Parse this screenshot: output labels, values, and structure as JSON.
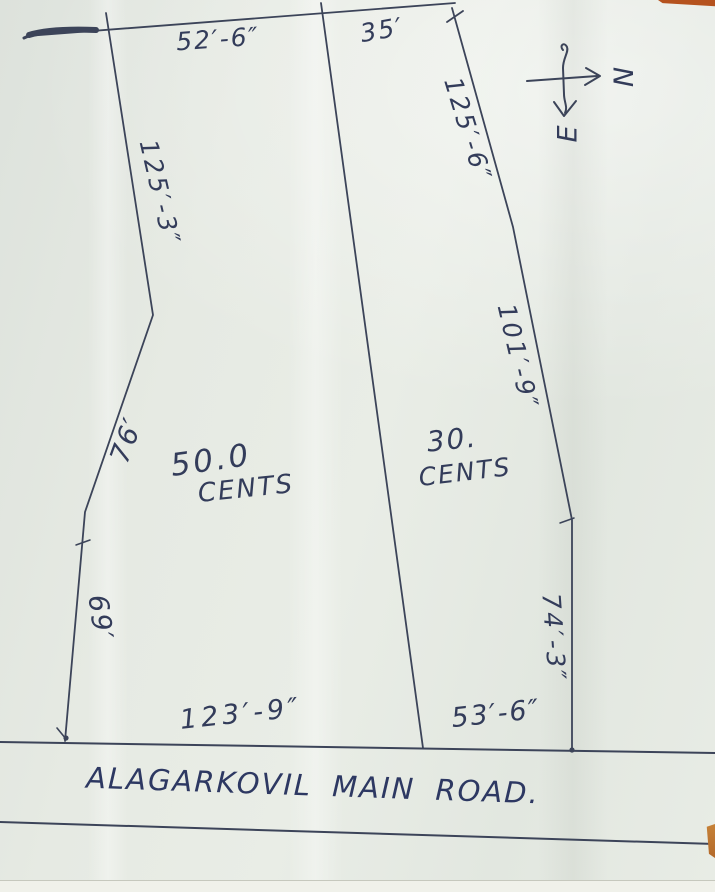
{
  "road": {
    "name": "ALAGARKOVIL MAIN ROAD."
  },
  "compass": {
    "north": "N",
    "east": "E"
  },
  "plots": {
    "west": {
      "area_value": "50.0",
      "area_unit": "CENTS",
      "dim_top": "52′-6″",
      "dim_upper_left": "125′-3″",
      "dim_mid_left": "76′",
      "dim_lower_left": "69′",
      "dim_bottom": "123′-9″"
    },
    "east": {
      "area_value": "30.",
      "area_unit": "CENTS",
      "dim_top": "35′",
      "dim_upper_right": "125′-6″",
      "dim_mid_right": "101′-9″",
      "dim_lower_right": "74′-3″",
      "dim_bottom": "53′-6″"
    }
  },
  "colors": {
    "ink": "#343d5a",
    "paper": "#e7ebe4",
    "photo_edge": "#b5521e"
  }
}
